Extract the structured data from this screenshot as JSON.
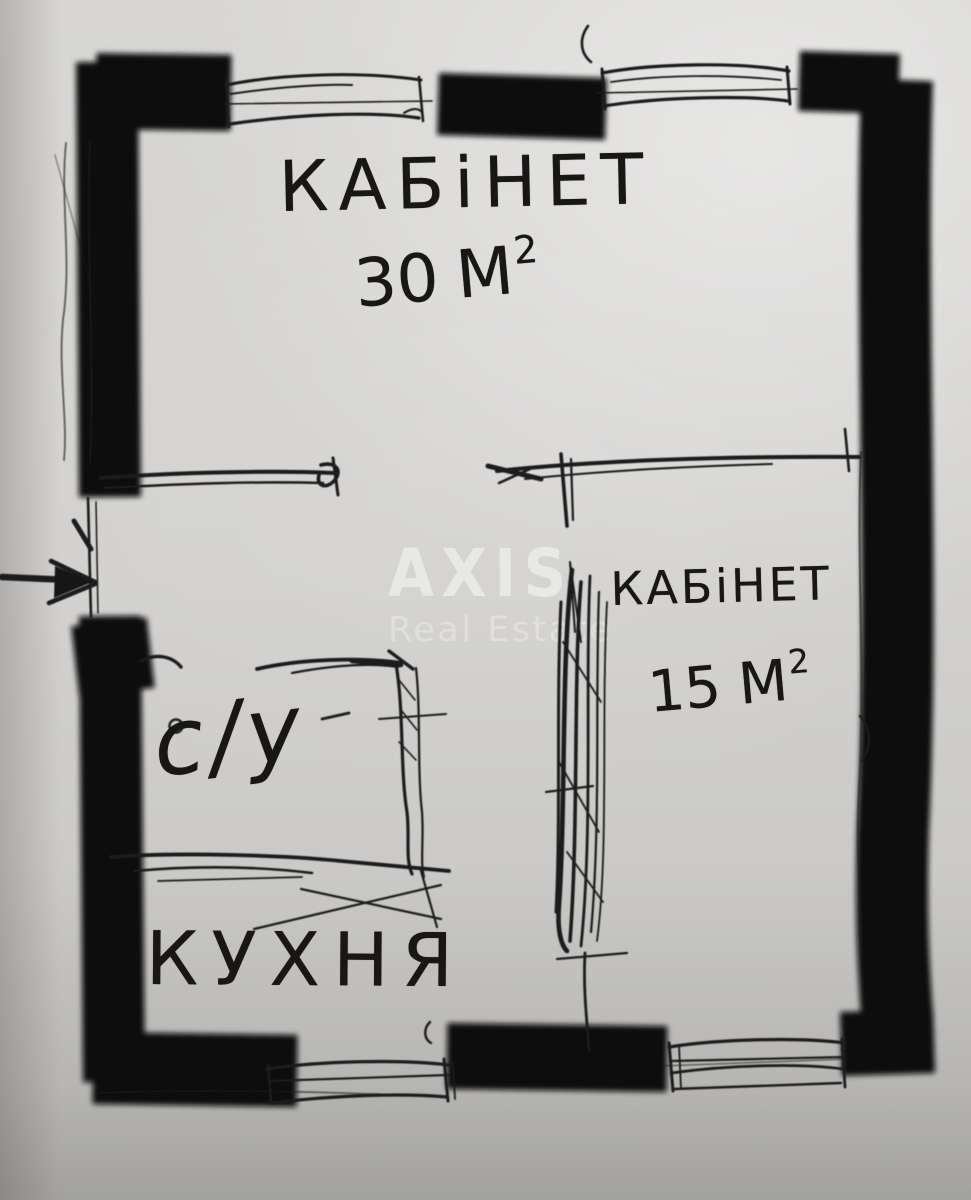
{
  "floorplan": {
    "watermark": {
      "brand": "AXIS",
      "tagline": "Real Estate"
    },
    "rooms": {
      "office_large": {
        "name": "КАБіНЕТ",
        "area_value": "30",
        "area_unit": "М",
        "area_sup": "2"
      },
      "office_small": {
        "name": "КАБіНЕТ",
        "area_value": "15",
        "area_unit": "М",
        "area_sup": "2"
      },
      "bathroom": {
        "name": "с/у"
      },
      "kitchen": {
        "name": "КУХНЯ"
      }
    },
    "colors": {
      "paper": "#d3d2d0",
      "ink": "#1c1b1a",
      "marker": "#0a0a09",
      "watermark": "#f8f7f5"
    }
  }
}
